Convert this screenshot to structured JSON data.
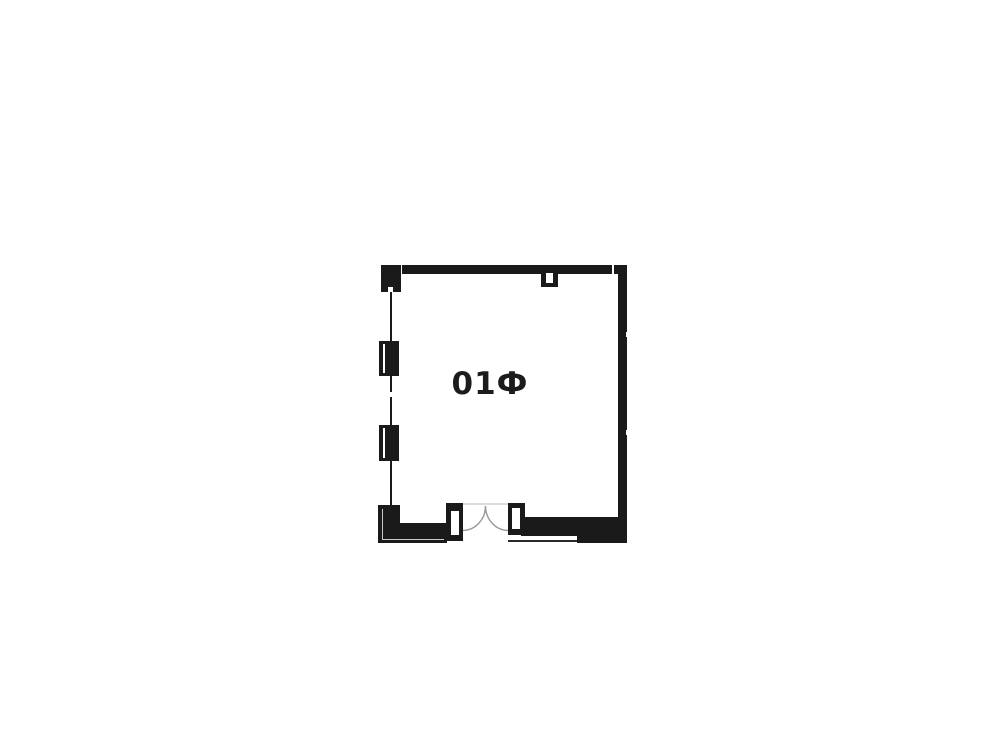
{
  "room": {
    "label": "01Ф"
  },
  "colors": {
    "wall": "#1a1a1a",
    "background": "#ffffff",
    "highlight": "#c8c8c8",
    "door_arc": "#999999",
    "header_line": "#dddddd",
    "label_text": "#1c1c1c"
  }
}
